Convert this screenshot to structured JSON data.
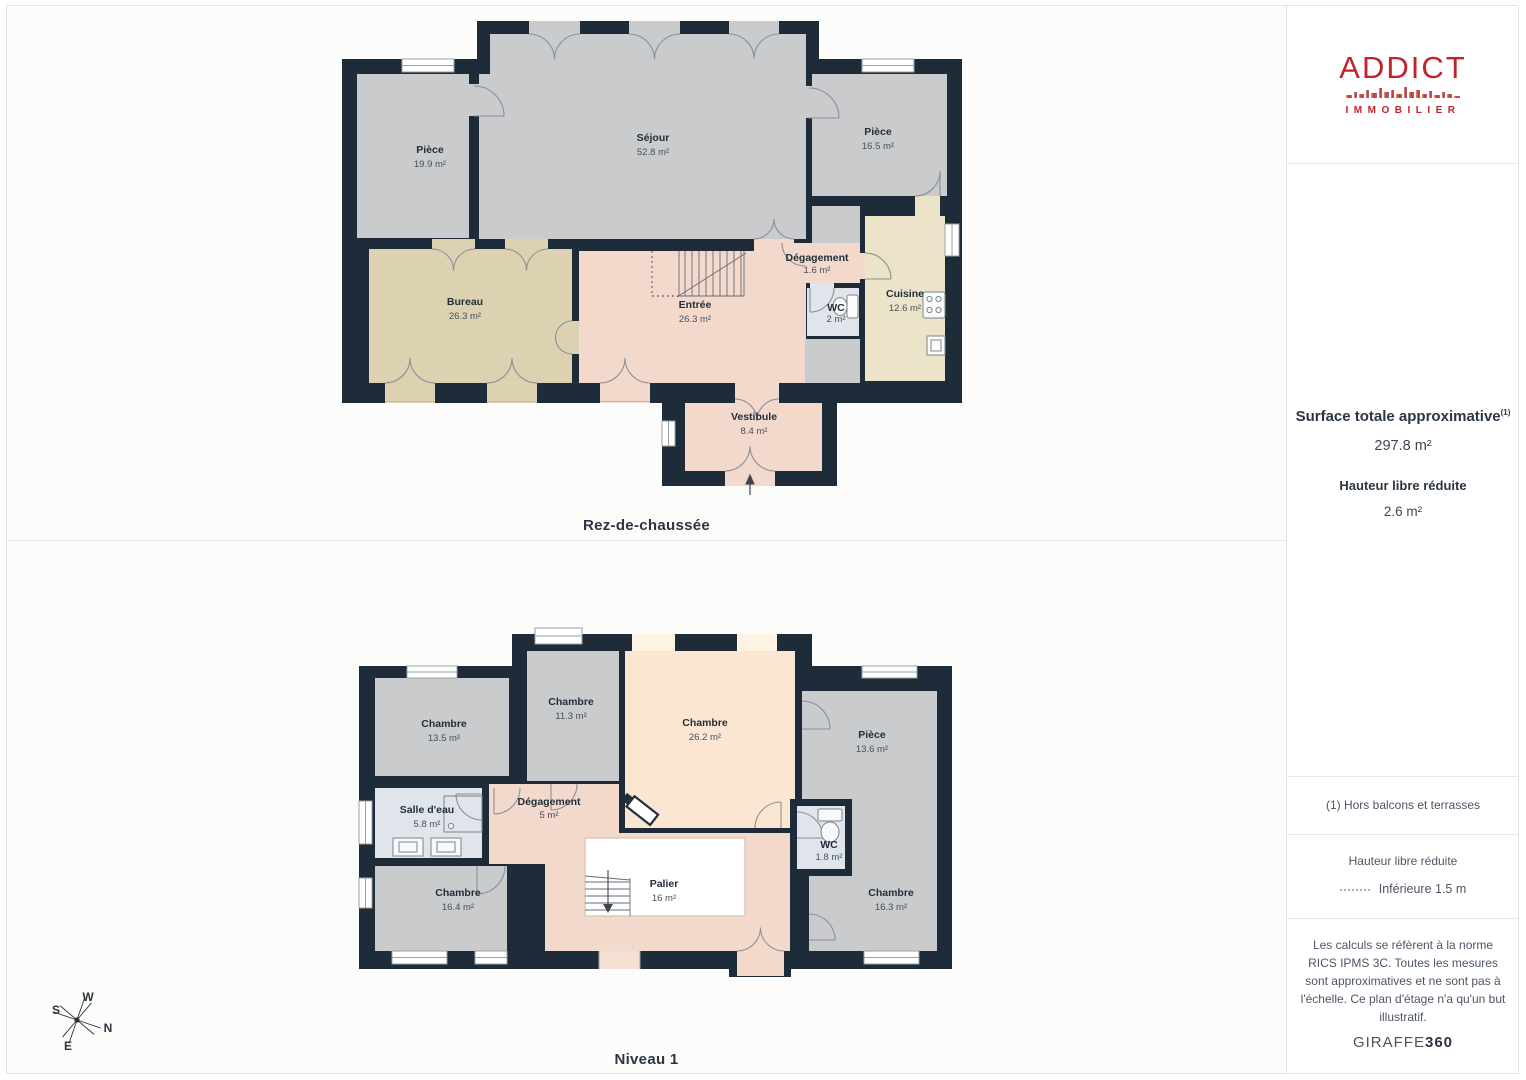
{
  "branding": {
    "logo_word": "ADDICT",
    "logo_sub": "IMMOBILIER"
  },
  "sidebar": {
    "surface_title": "Surface totale approximative",
    "surface_sup": "(1)",
    "surface_value": "297.8 m²",
    "height_title": "Hauteur libre réduite",
    "height_value": "2.6 m²",
    "note1": "(1) Hors balcons et terrasses",
    "legend_title": "Hauteur libre réduite",
    "legend_item": "Inférieure 1.5 m",
    "disclaimer": "Les calculs se réfèrent à la norme RICS IPMS 3C. Toutes les mesures sont approximatives et ne sont pas à l'échelle. Ce plan d'étage n'a qu'un but illustratif.",
    "brand_name": "GIRAFFE",
    "brand_suffix": "360"
  },
  "compass": {
    "n": "N",
    "s": "S",
    "e": "E",
    "w": "W"
  },
  "floors": {
    "rdc": {
      "label": "Rez-de-chaussée",
      "rooms": [
        {
          "name": "Pièce",
          "area": "19.9 m²"
        },
        {
          "name": "Séjour",
          "area": "52.8 m²"
        },
        {
          "name": "Pièce",
          "area": "16.5 m²"
        },
        {
          "name": "Bureau",
          "area": "26.3 m²"
        },
        {
          "name": "Entrée",
          "area": "26.3 m²"
        },
        {
          "name": "Dégagement",
          "area": "1.6 m²"
        },
        {
          "name": "WC",
          "area": "2 m²"
        },
        {
          "name": "Cuisine",
          "area": "12.6 m²"
        },
        {
          "name": "Vestibule",
          "area": "8.4 m²"
        }
      ]
    },
    "niveau1": {
      "label": "Niveau 1",
      "rooms": [
        {
          "name": "Chambre",
          "area": "13.5 m²"
        },
        {
          "name": "Chambre",
          "area": "11.3 m²"
        },
        {
          "name": "Chambre",
          "area": "26.2 m²"
        },
        {
          "name": "Pièce",
          "area": "13.6 m²"
        },
        {
          "name": "Salle d'eau",
          "area": "5.8 m²"
        },
        {
          "name": "Dégagement",
          "area": "5 m²"
        },
        {
          "name": "WC",
          "area": "1.8 m²"
        },
        {
          "name": "Chambre",
          "area": "16.4 m²"
        },
        {
          "name": "Palier",
          "area": "16 m²"
        },
        {
          "name": "Chambre",
          "area": "16.3 m²"
        }
      ]
    }
  },
  "colors": {
    "wall": "#1e2b38",
    "room_gray": "#c9cbcc",
    "room_pink": "#f3d9cb",
    "room_tan": "#dcd2b2",
    "room_cream": "#ece4c8",
    "room_peach": "#fbe7d1",
    "room_blue": "#e0e5ec",
    "accent_red": "#c3222c"
  }
}
